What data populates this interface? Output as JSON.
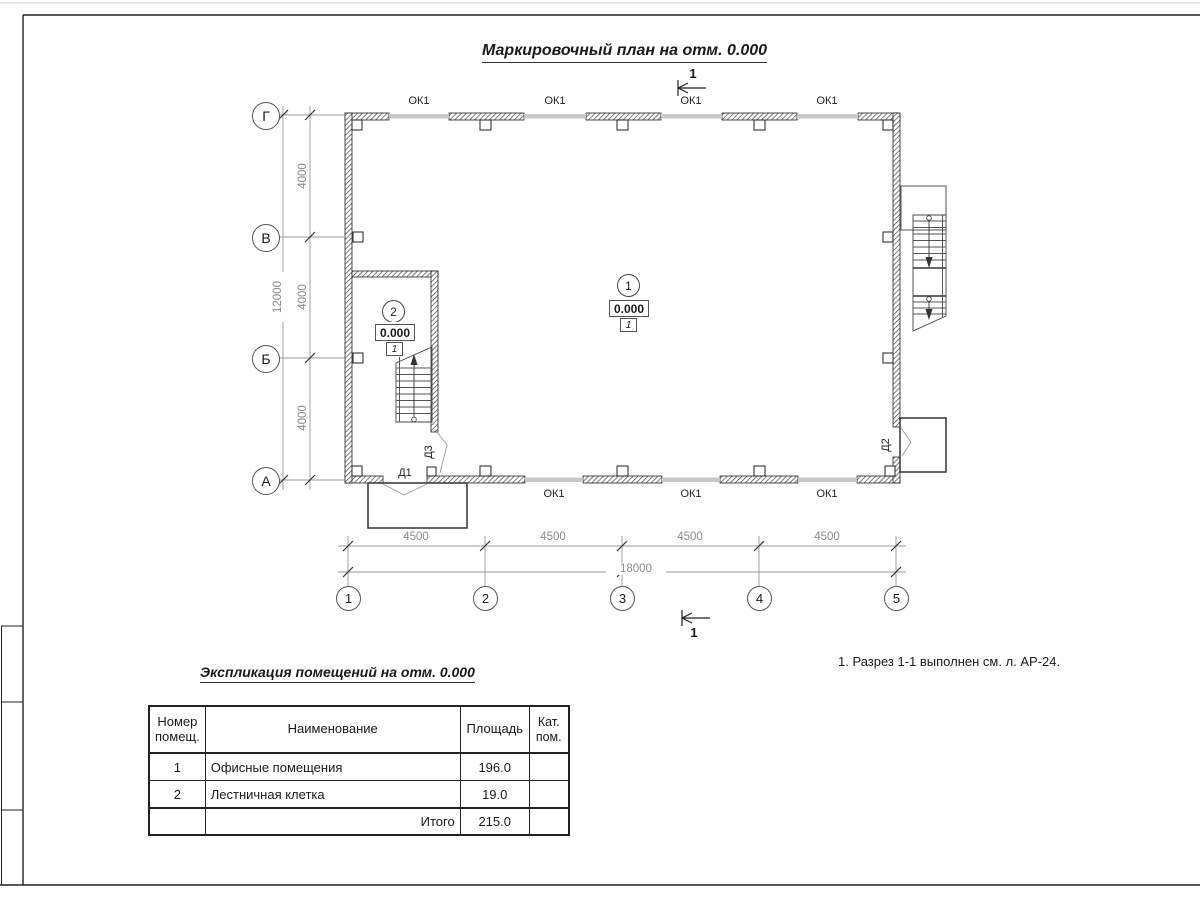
{
  "page": {
    "title": "Маркировочный план на отм. 0.000",
    "note": "1. Разрез 1-1 выполнен см. л. АР-24."
  },
  "plan": {
    "section_mark_top": "1",
    "section_mark_bottom": "1",
    "window_labels_top": [
      "ОК1",
      "ОК1",
      "ОК1",
      "ОК1"
    ],
    "window_labels_bottom": [
      "ОК1",
      "ОК1",
      "ОК1"
    ],
    "doors": {
      "d1": "Д1",
      "d2": "Д2",
      "d3": "Д3"
    },
    "rooms": [
      {
        "number": "1",
        "elevation": "0.000",
        "floor_type": "1"
      },
      {
        "number": "2",
        "elevation": "0.000",
        "floor_type": "1"
      }
    ],
    "axes": {
      "rows": [
        "Г",
        "В",
        "Б",
        "А"
      ],
      "cols": [
        "1",
        "2",
        "3",
        "4",
        "5"
      ]
    },
    "dims": {
      "col_segments": [
        "4500",
        "4500",
        "4500",
        "4500"
      ],
      "col_total": "18000",
      "row_segments": [
        "4000",
        "4000",
        "4000"
      ],
      "row_total": "12000"
    }
  },
  "table": {
    "title": "Экспликация помещений на отм. 0.000",
    "headers": {
      "number": "Номер помещ.",
      "name": "Наименование",
      "area": "Площадь",
      "cat": "Кат. пом."
    },
    "rows": [
      {
        "number": "1",
        "name": "Офисные помещения",
        "area": "196.0",
        "cat": ""
      },
      {
        "number": "2",
        "name": "Лестничная клетка",
        "area": "19.0",
        "cat": ""
      }
    ],
    "total_label": "Итого",
    "total_area": "215.0"
  },
  "colors": {
    "line": "#222222",
    "window_gray": "#c8c8c8",
    "dim_gray": "#8a8a8a"
  }
}
